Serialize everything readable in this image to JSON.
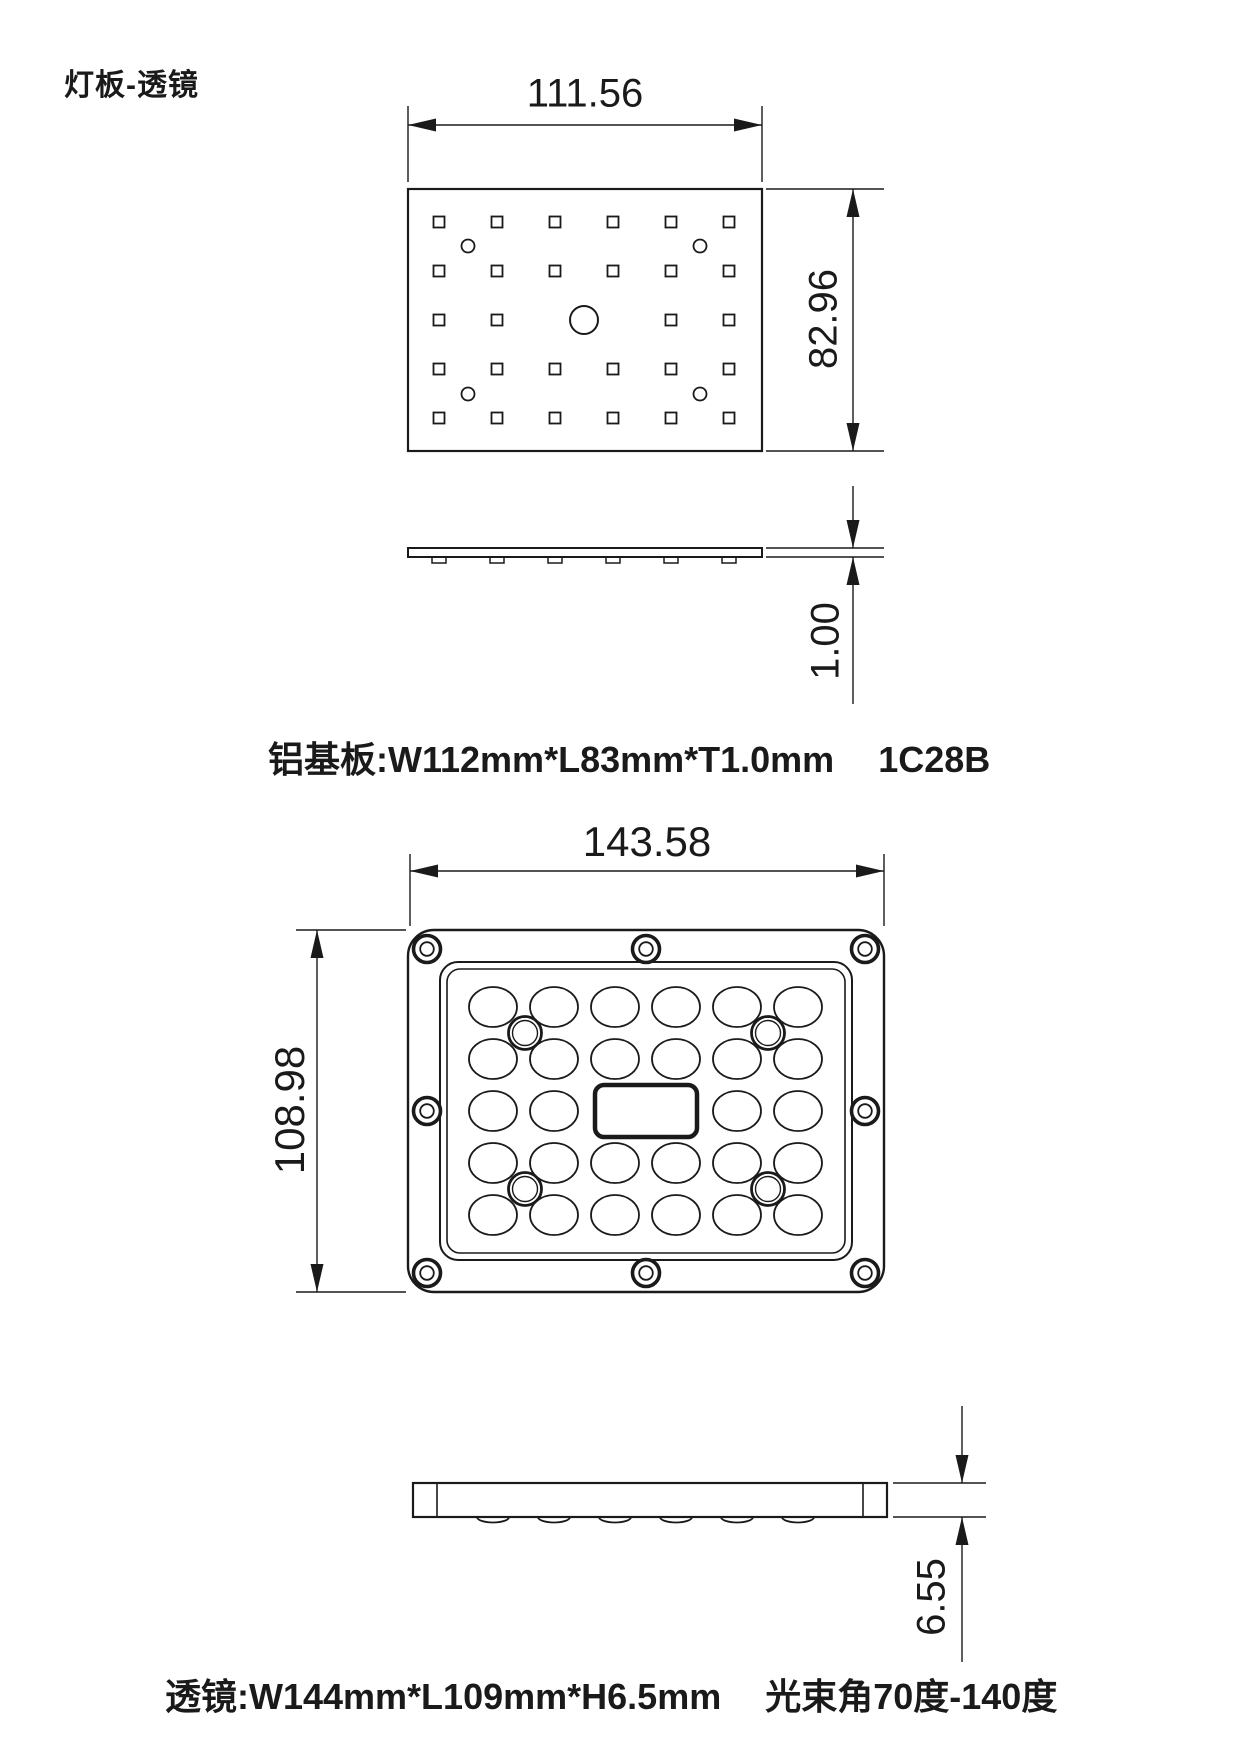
{
  "title": "灯板-透镜",
  "colors": {
    "line": "#1a1a1a",
    "background": "#ffffff"
  },
  "pcb": {
    "dim_width": "111.56",
    "dim_height": "82.96",
    "dim_thickness": "1.00",
    "caption_spec": "铝基板:W112mm*L83mm*T1.0mm",
    "caption_code": "1C28B",
    "grid": {
      "cols": 6,
      "rows": 5,
      "led_count": 28,
      "mounting_holes": 4,
      "center_hole": 1
    }
  },
  "lens": {
    "dim_width": "143.58",
    "dim_height": "108.98",
    "dim_thickness": "6.55",
    "caption_spec": "透镜:W144mm*L109mm*H6.5mm",
    "caption_beam": "光束角70度-140度",
    "grid": {
      "cols": 6,
      "rows": 5,
      "lens_count": 28,
      "screw_holes": 8,
      "alignment_posts": 4
    }
  }
}
